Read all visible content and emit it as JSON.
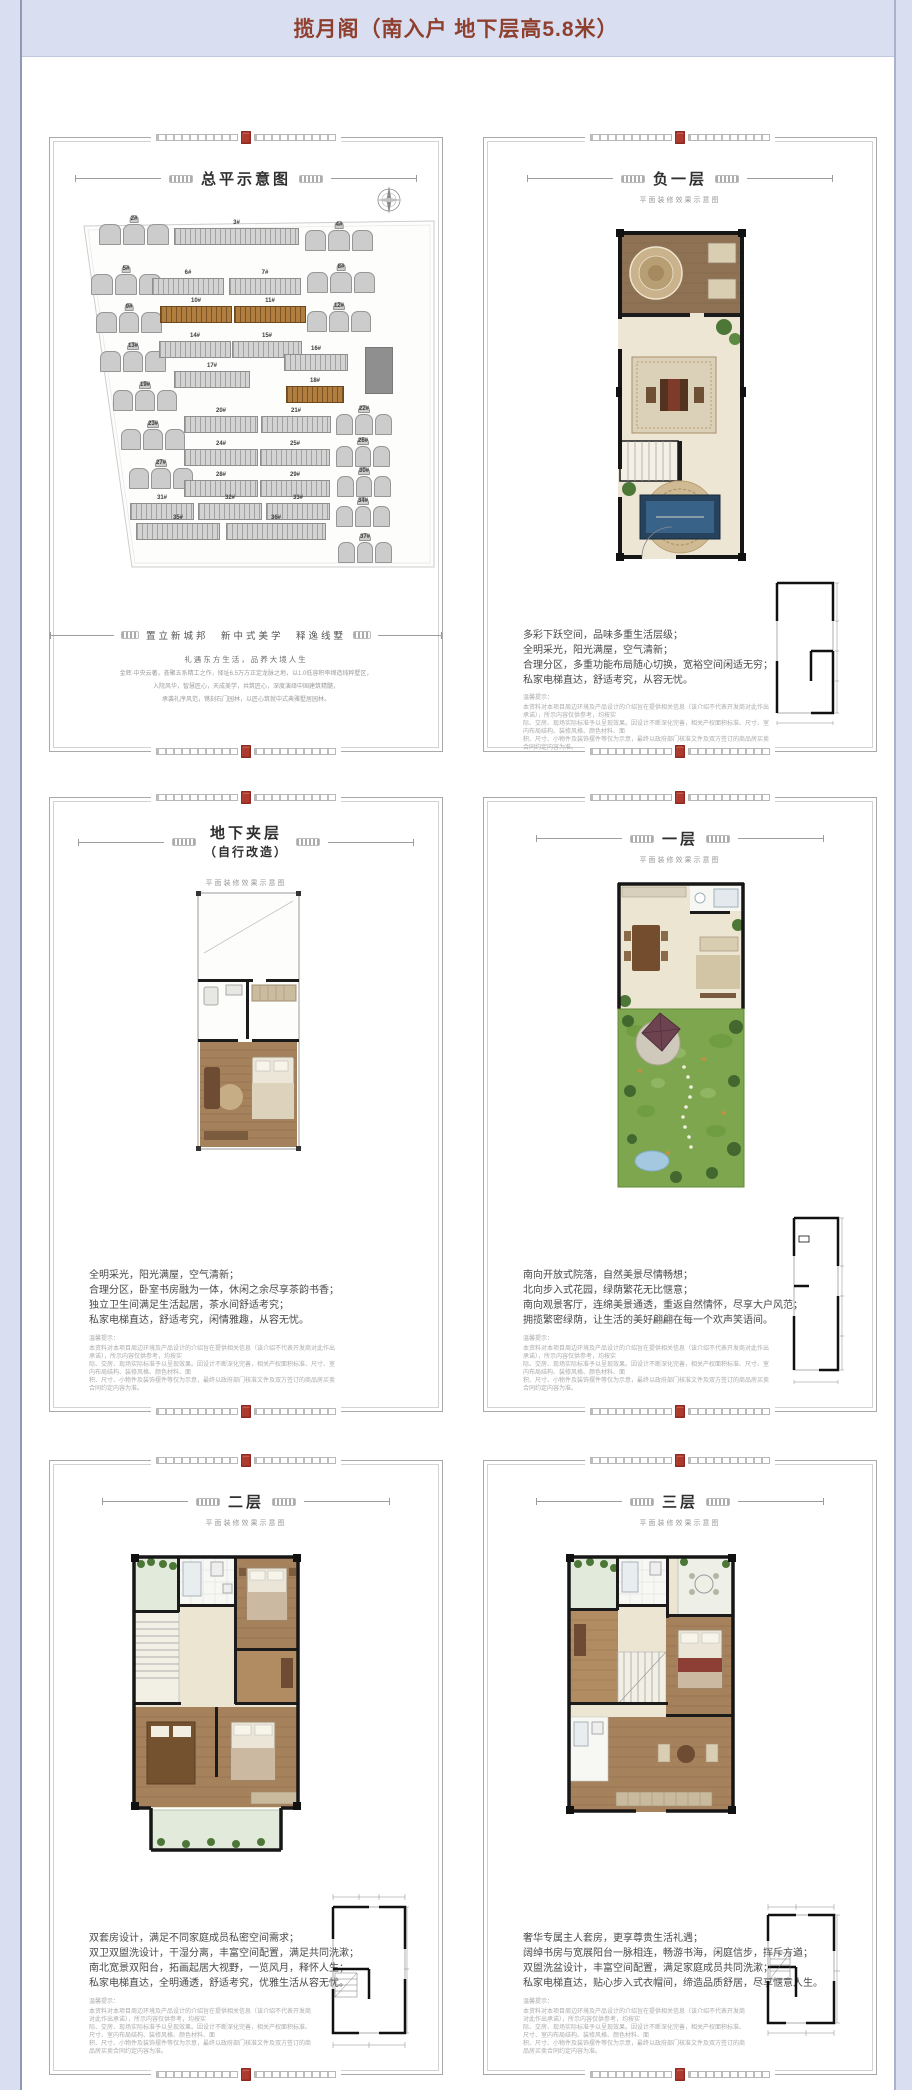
{
  "header": {
    "title": "揽月阁（南入户 地下层高5.8米）"
  },
  "colors": {
    "page_band": "#d9def0",
    "title_red": "#8e3f2d",
    "seal_red": "#b0392e",
    "highlight_brown": "#b07f3f"
  },
  "common": {
    "subtitle": "平面装修效果示意图",
    "notice_label": "温馨提示：",
    "disclaimer": [
      "本资料对本项目周边环境及产品设计的介绍旨在提供相关信息（该介绍不代表开发商对此作出承诺），所示内容仅供参考，均按实",
      "际、交房、现场实际标准予以呈现效果。因设计不断深化完善，相关产权面积标准、尺寸、室内布局结构、装修风格、颜色材料、面",
      "积、尺寸、小物件及装饰摆件等仅为示意，最终以政府部门核准文件及双方签订的商品房买卖合同约定内容为准。"
    ]
  },
  "site_panel": {
    "title": "总平示意图",
    "tagline": "置立新城邦　新中式美学　释逸线墅",
    "slogan": "礼遇东方生活，品养大境人生",
    "paragraph": [
      "金辉·中央云著，荟聚五系精工之作，择址6.5万方正定龙脉之地，以1.0低容积率缔造纯粹墅区，",
      "入院风华，智慧匠心，天成美学，共筑匠心，深度演绎中国建筑精髓，",
      "承袭礼序风范，镌刻石门园林，以匠心筑就中式典雅墅居园林。"
    ],
    "buildings": [
      {
        "label": "2#",
        "type": "villa",
        "x": 25,
        "y": 8,
        "w": 70
      },
      {
        "label": "3#",
        "type": "slab",
        "x": 100,
        "y": 12,
        "w": 125
      },
      {
        "label": "4#",
        "type": "villa",
        "x": 231,
        "y": 14,
        "w": 68
      },
      {
        "label": "5#",
        "type": "villa",
        "x": 17,
        "y": 58,
        "w": 70
      },
      {
        "label": "6#",
        "type": "slab",
        "x": 78,
        "y": 62,
        "w": 72
      },
      {
        "label": "7#",
        "type": "slab",
        "x": 155,
        "y": 62,
        "w": 72
      },
      {
        "label": "8#",
        "type": "villa",
        "x": 233,
        "y": 56,
        "w": 68
      },
      {
        "label": "9#",
        "type": "villa",
        "x": 22,
        "y": 96,
        "w": 66
      },
      {
        "label": "10#",
        "type": "hl",
        "x": 86,
        "y": 90,
        "w": 72
      },
      {
        "label": "11#",
        "type": "hl",
        "x": 160,
        "y": 90,
        "w": 72
      },
      {
        "label": "12#",
        "type": "villa",
        "x": 233,
        "y": 95,
        "w": 64
      },
      {
        "label": "13#",
        "type": "villa",
        "x": 26,
        "y": 135,
        "w": 66
      },
      {
        "label": "14#",
        "type": "slab",
        "x": 85,
        "y": 125,
        "w": 72
      },
      {
        "label": "15#",
        "type": "slab",
        "x": 158,
        "y": 125,
        "w": 70
      },
      {
        "label": "16#",
        "type": "slab",
        "x": 210,
        "y": 138,
        "w": 64
      },
      {
        "label": "",
        "type": "block",
        "x": 291,
        "y": 131,
        "w": 28,
        "h": 47
      },
      {
        "label": "17#",
        "type": "slab",
        "x": 100,
        "y": 155,
        "w": 76
      },
      {
        "label": "18#",
        "type": "hl",
        "x": 212,
        "y": 170,
        "w": 58
      },
      {
        "label": "19#",
        "type": "villa",
        "x": 39,
        "y": 174,
        "w": 64
      },
      {
        "label": "20#",
        "type": "slab",
        "x": 110,
        "y": 200,
        "w": 74
      },
      {
        "label": "21#",
        "type": "slab",
        "x": 187,
        "y": 200,
        "w": 70
      },
      {
        "label": "22#",
        "type": "villa",
        "x": 262,
        "y": 198,
        "w": 56
      },
      {
        "label": "23#",
        "type": "villa",
        "x": 47,
        "y": 213,
        "w": 64
      },
      {
        "label": "24#",
        "type": "slab",
        "x": 110,
        "y": 233,
        "w": 74
      },
      {
        "label": "25#",
        "type": "slab",
        "x": 186,
        "y": 233,
        "w": 70
      },
      {
        "label": "26#",
        "type": "villa",
        "x": 262,
        "y": 230,
        "w": 54
      },
      {
        "label": "27#",
        "type": "villa",
        "x": 55,
        "y": 252,
        "w": 64
      },
      {
        "label": "28#",
        "type": "slab",
        "x": 110,
        "y": 264,
        "w": 74
      },
      {
        "label": "29#",
        "type": "slab",
        "x": 186,
        "y": 264,
        "w": 70
      },
      {
        "label": "30#",
        "type": "villa",
        "x": 263,
        "y": 260,
        "w": 54
      },
      {
        "label": "31#",
        "type": "slab",
        "x": 56,
        "y": 287,
        "w": 64
      },
      {
        "label": "32#",
        "type": "slab",
        "x": 124,
        "y": 287,
        "w": 64
      },
      {
        "label": "33#",
        "type": "slab",
        "x": 192,
        "y": 287,
        "w": 64
      },
      {
        "label": "34#",
        "type": "villa",
        "x": 262,
        "y": 290,
        "w": 54
      },
      {
        "label": "35#",
        "type": "slab",
        "x": 62,
        "y": 307,
        "w": 84
      },
      {
        "label": "36#",
        "type": "slab",
        "x": 152,
        "y": 307,
        "w": 100
      },
      {
        "label": "37#",
        "type": "villa",
        "x": 264,
        "y": 326,
        "w": 54
      }
    ]
  },
  "floor_panels": [
    {
      "title": "负一层",
      "title2": "",
      "desc": [
        "多彩下跃空间，品味多重生活层级；",
        "全明采光，阳光满屋，空气清新；",
        "合理分区，多重功能布局随心切换，宽裕空间闲适无穷；",
        "私家电梯直达，舒适考究，从容无忧。"
      ]
    },
    {
      "title": "地下夹层",
      "title2": "（自行改造）",
      "desc": [
        "全明采光，阳光满屋，空气清新；",
        "合理分区，卧室书房融为一体，休闲之余尽享茶韵书香；",
        "独立卫生间满足生活起居，茶水间舒适考究；",
        "私家电梯直达，舒适考究，闲情雅趣，从容无忧。"
      ]
    },
    {
      "title": "一层",
      "title2": "",
      "desc": [
        "南向开放式院落，自然美景尽情畅想；",
        "北向步入式花园，绿荫繁花无比惬意；",
        "南向观景客厅，连绵美景通透，重返自然情怀，尽享大户风范；",
        "拥揽繁密绿荫，让生活的美好翩翩在每一个欢声笑语间。"
      ]
    },
    {
      "title": "二层",
      "title2": "",
      "desc": [
        "双套房设计，满足不同家庭成员私密空间需求；",
        "双卫双盥洗设计，干湿分离，丰富空间配置，满足共同洗漱；",
        "南北宽景双阳台，拓画起居大视野，一览风月，释怀人生；",
        "私家电梯直达，全明通透，舒适考究，优雅生活从容无忧。"
      ]
    },
    {
      "title": "三层",
      "title2": "",
      "desc": [
        "奢华专属主人套房，更享尊贵生活礼遇；",
        "阔绰书房与宽展阳台一脉相连，畅游书海，闲庭信步，挥斥方遒；",
        "双盥洗盆设计，丰富空间配置，满足家庭成员共同洗漱；",
        "私家电梯直达，贴心步入式衣帽间，缔造品质舒居，尽享惬意人生。"
      ]
    }
  ]
}
